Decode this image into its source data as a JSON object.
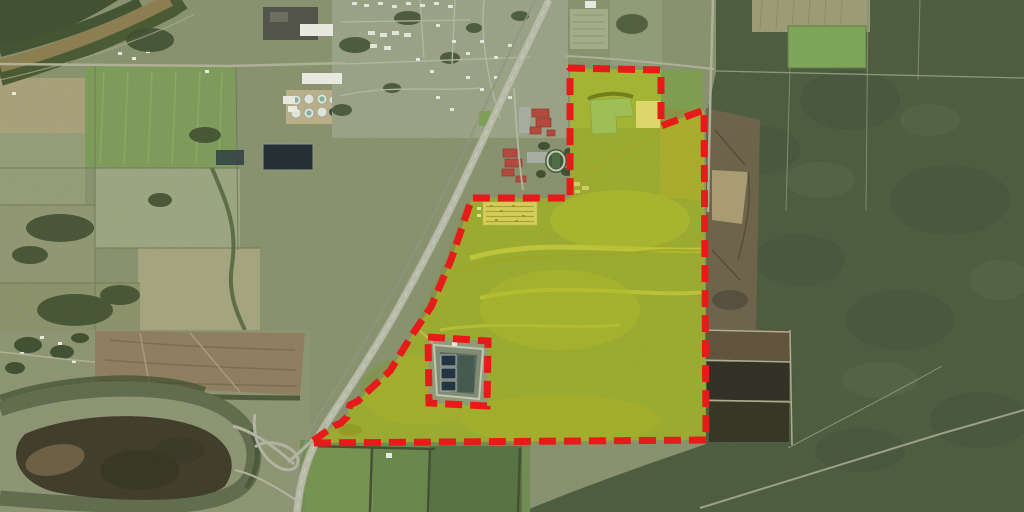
{
  "annotation": {
    "parcel_ring": "M568,68 L661,70 L661,126 L704,110 L706,440 L310,443 L334,426 L341,423 L347,417 L350,405 L358,401 L366,393 L390,371 L412,335 L431,307 L451,260 L472,198 L570,198 L570,68 Z",
    "exclusion_ring": "M428,337 L488,341 L487,406 L429,403 Z",
    "overlay_path": "M568,68 L661,70 L661,126 L704,110 L706,440 L310,443 L334,426 L341,423 L347,417 L350,405 L358,401 L366,393 L390,371 L412,335 L431,307 L451,260 L472,198 L570,198 L570,68 Z M428,337 L488,341 L487,406 L429,403 Z",
    "boundary_color": "#e91414",
    "boundary_width": 7,
    "boundary_dash": "17 8",
    "highlight_color": "#e0d800",
    "highlight_opacity": 0.38
  },
  "colors": {
    "terrain_base": "#87906c",
    "forest": "#4a593b",
    "forest_dark": "#3d4d2d",
    "river": "#8a7c4c",
    "oxbow": "#5e6a4a",
    "island": "#3d3926",
    "road": "#b8bba8",
    "road_minor": "#aeb096",
    "building": "#e9eae0",
    "roof_red": "#b2453a",
    "pond": "#74b184",
    "basin": "#1d2f3e",
    "dark_field": "#2e2c20",
    "scrub": "#6d6148",
    "parcel_field": "#6f8f47"
  }
}
